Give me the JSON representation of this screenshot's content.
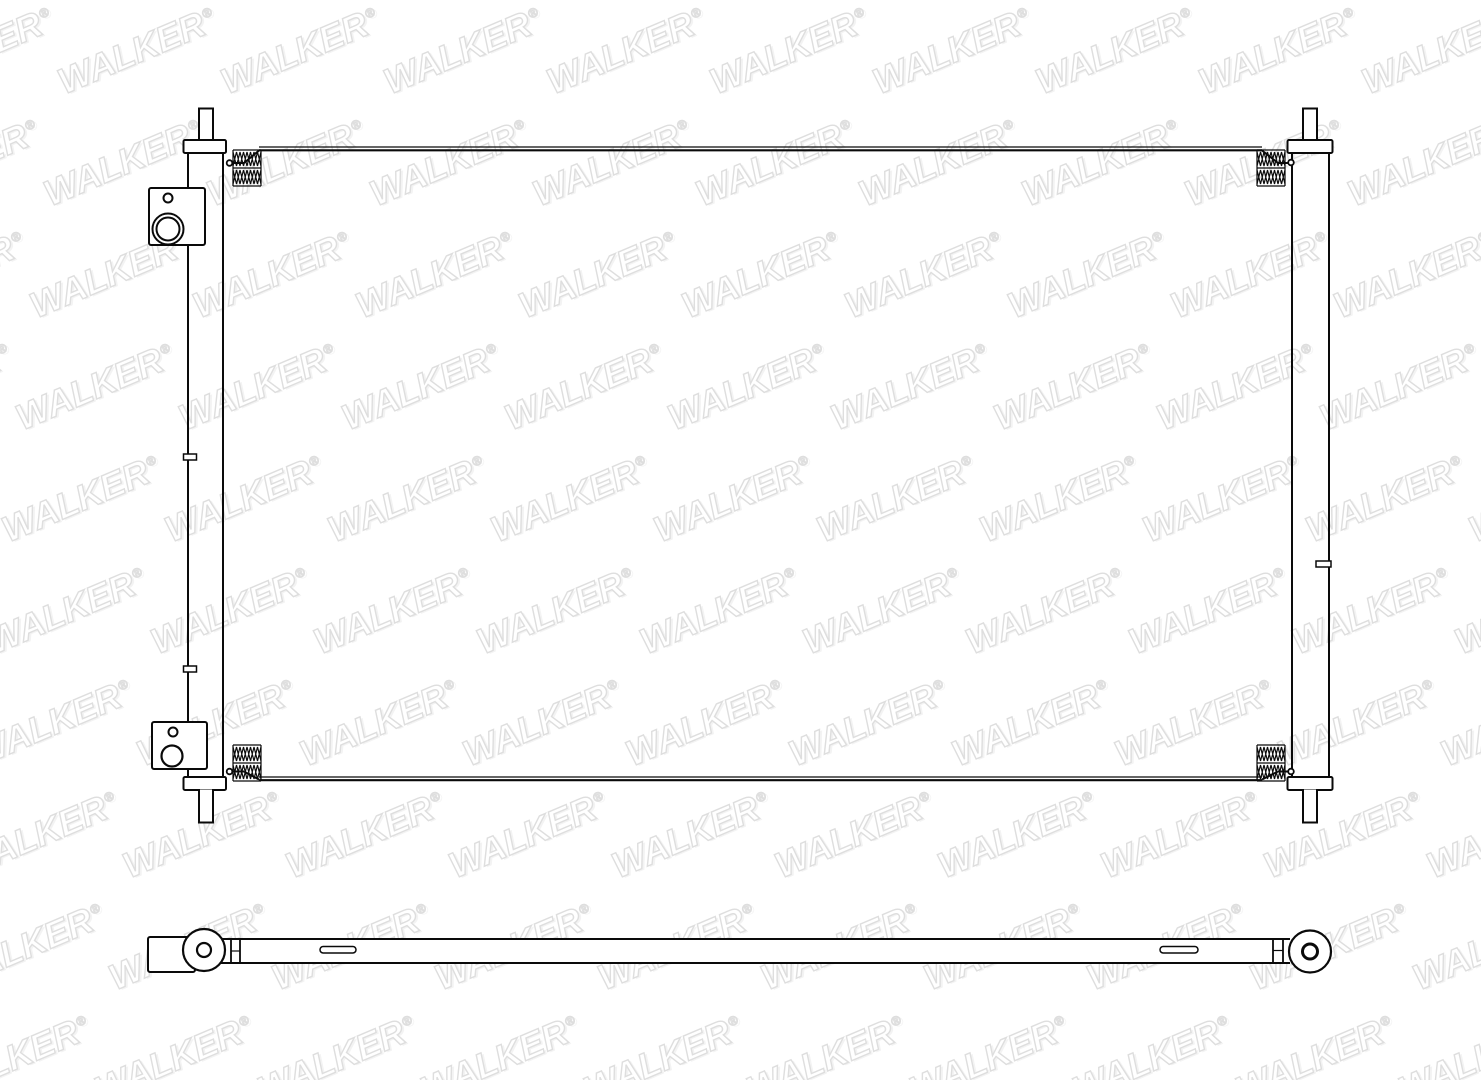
{
  "watermark": {
    "text": "WALKER",
    "registered_mark": "®",
    "outline_color": "#dedede"
  },
  "drawing": {
    "background": "#ffffff",
    "line_color": "#0a0a0a",
    "views": {
      "front_view": "condenser-front-view",
      "bottom_view": "condenser-bottom-view"
    }
  }
}
